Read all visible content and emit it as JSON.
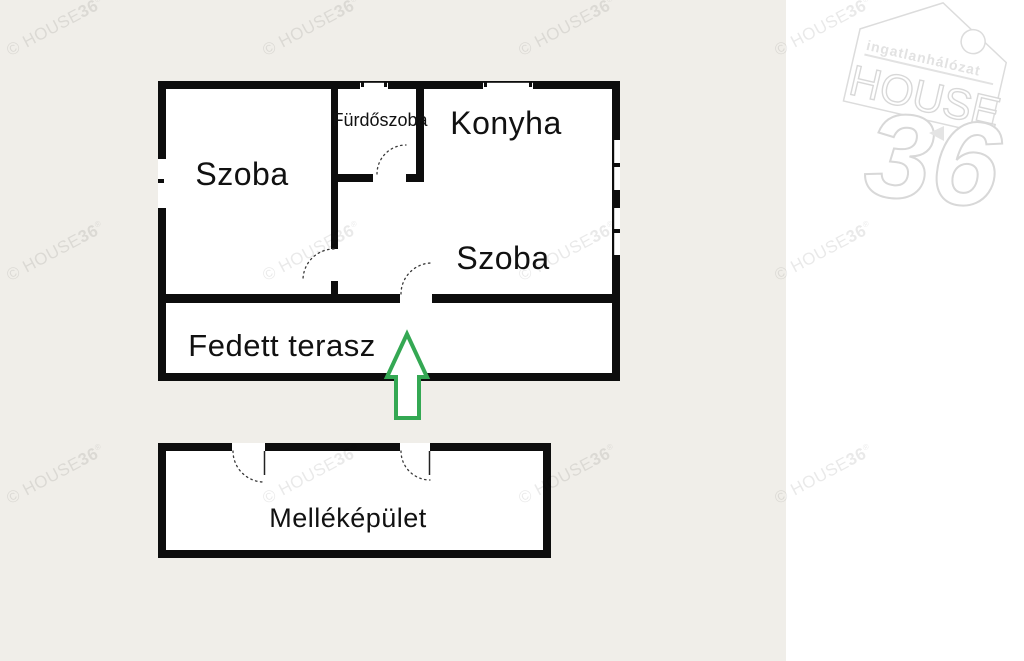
{
  "canvas": {
    "background_color": "#f0eee9",
    "panel_color": "#ffffff",
    "wall_color": "#0d0d0d",
    "arrow_color": "#34a853",
    "label_color": "#111111"
  },
  "floorplan": {
    "labels": {
      "szoba_left": "Szoba",
      "furdoszoba": "Fürdőszoba",
      "konyha": "Konyha",
      "szoba_right": "Szoba",
      "fedett_terasz": "Fedett terasz",
      "mellekepulet": "Melléképület"
    }
  },
  "watermark": {
    "prefix": "© HOUSE",
    "bold": "36",
    "reg": "®",
    "positions": [
      [
        8,
        42
      ],
      [
        264,
        42
      ],
      [
        520,
        42
      ],
      [
        776,
        42
      ],
      [
        8,
        267
      ],
      [
        264,
        267
      ],
      [
        520,
        267
      ],
      [
        776,
        267
      ],
      [
        8,
        490
      ],
      [
        264,
        490
      ],
      [
        520,
        490
      ],
      [
        776,
        490
      ]
    ]
  },
  "logo": {
    "subtitle": "ingatlanhálózat",
    "title": "HOUSE",
    "number": "36"
  }
}
